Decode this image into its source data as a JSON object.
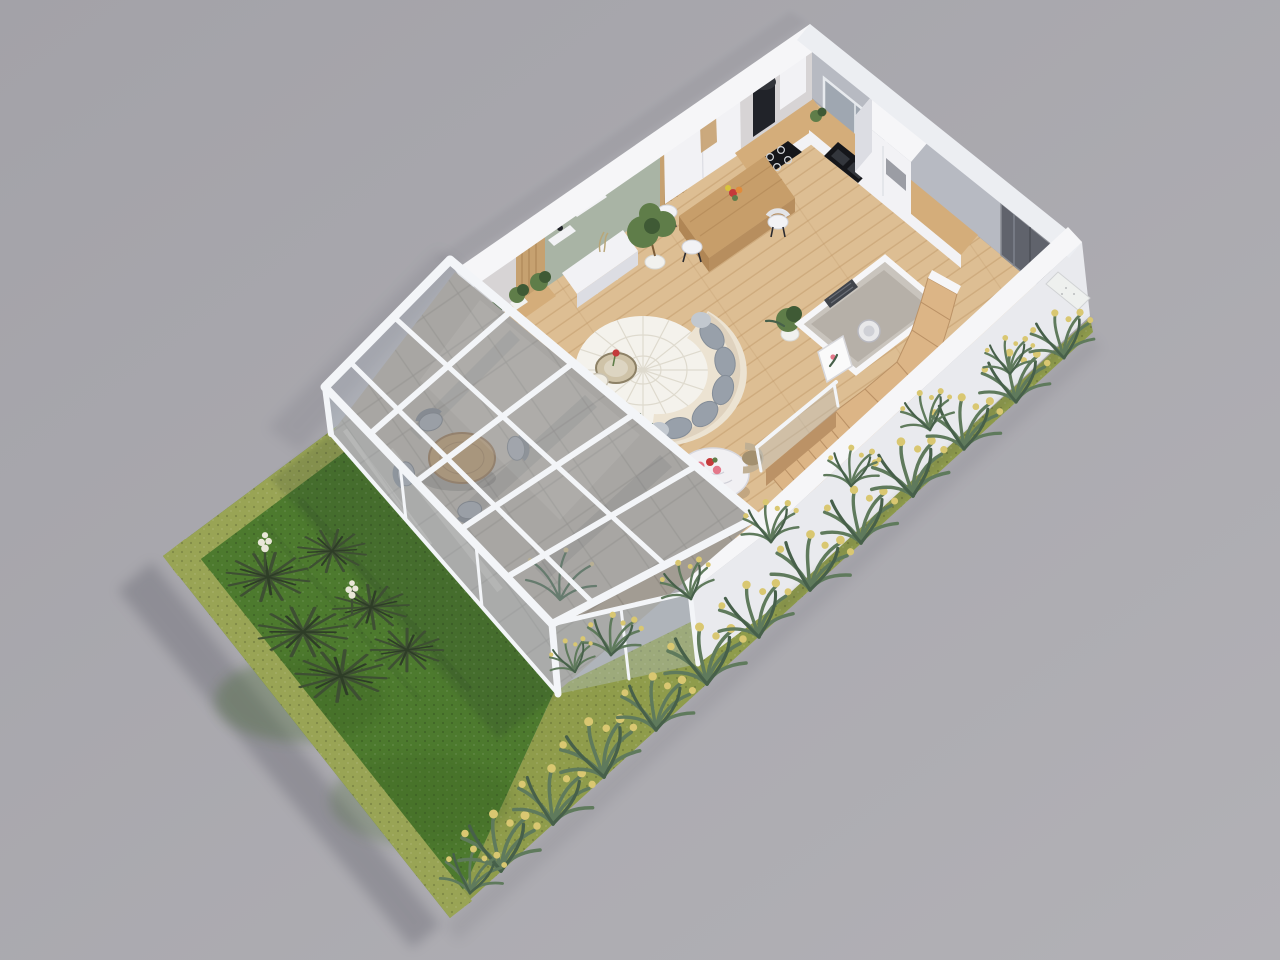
{
  "scene": {
    "type": "architectural-3d-floor-plan-render",
    "view": "aerial isometric cutaway, ground floor",
    "subject": "modern single-family house ground floor with glazed conservatory and garden strip",
    "background": "plain studio gray"
  },
  "objects": [
    "garden lawn with hedge border",
    "yucca planting island with white bloom spikes",
    "ornamental grass bed with yellow flowers along facade",
    "glazed conservatory with patio dining table and four chairs",
    "open-plan living room with curved cream sofa, round rug and coffee table with red tulip",
    "kitchen with white cabinets, black cylinder hood, cooktop, sink and window",
    "wooden breakfast island with bar stools and flower vase",
    "small marble bistro table with two tan chairs and pink bouquet",
    "WC / utility room with towel radiator and washer",
    "winder wooden staircase with glass balustrade",
    "entrance hall with dark glazed front door and doormat",
    "sage-green media wall with shelves, plants and white TV console"
  ],
  "colors": {
    "bg_a": "#a3a2a8",
    "bg_b": "#b2b1b6",
    "ground_shadow": "#4c4c58",
    "wall_top": "#f6f6f8",
    "wall_top_shade": "#eceef2",
    "wall_face": "#e9eaee",
    "wall_face_shade": "#d9dbe1",
    "wall_inner_warm": "#d7d4d5",
    "wall_inner_cool": "#b7bac2",
    "window_glass": "#9fa7b1",
    "door_dark": "#60636c",
    "floor_wood": "#ddbe93",
    "floor_plank": "#c09868",
    "counter_wood": "#d4ad7a",
    "island_wood": "#c79e6a",
    "island_wood_dark": "#b08655",
    "cabinet_white": "#f2f2f5",
    "cabinet_shade": "#dcdde3",
    "appliance_black": "#212329",
    "cooktop_black": "#15161a",
    "sage_panel": "#a9b4a5",
    "slat_wood": "#c6a170",
    "slat_line": "#a57f4e",
    "rug_white": "#f4f2ec",
    "rug_line": "#dbd6c9",
    "sofa_cream": "#ece3d2",
    "sofa_shade": "#d5c5ad",
    "cushion_gray": "#98a0aa",
    "cushion_edge": "#848d98",
    "pillow_light": "#c2c8cf",
    "coffee_glass": "#cfc3a8",
    "coffee_rim": "#8d8166",
    "marble_white": "#f1f0f3",
    "marble_vein": "#c7c7cf",
    "chair_tan": "#c0af93",
    "chair_tan_dark": "#a3906f",
    "flower_pink": "#e4788a",
    "flower_red": "#c43a3a",
    "leaf_green": "#5f7d49",
    "plant_dark": "#3f5a35",
    "pot_white": "#f1f1ee",
    "stairs_wood": "#dcb586",
    "stairs_riser": "#bb9266",
    "glass_pane": "#b6c2cb",
    "glass_frame": "#f3f5f8",
    "frame_shade": "#c6cbd4",
    "stone_floor": "#a29c93",
    "stone_line": "#88827a",
    "curtain_gray": "#b5b9c0",
    "curtain_light": "#c8ccd2",
    "lawn_green": "#4d7a2e",
    "lawn_shade": "#3a6122",
    "hedge_green": "#99a455",
    "hedge_shade": "#7d8b40",
    "bed_ground": "#8f9c4b",
    "strip_leaf": "#5f7a5c",
    "strip_leaf_dark": "#47604a",
    "flower_yellow": "#d9c771",
    "yucca_green": "#3e4f33",
    "yucca_dark": "#2e3d27",
    "bloom_white": "#e9e7d8",
    "radiator_dark": "#41454c",
    "doormat_white": "#eef0ee",
    "wc_floor": "#b6b0a8",
    "wc_wall": "#c9c4bd",
    "patio_chair": "#8f9298",
    "patio_chair_dark": "#73767c",
    "patio_table": "#a2865f",
    "patio_table_dark": "#85684a"
  }
}
